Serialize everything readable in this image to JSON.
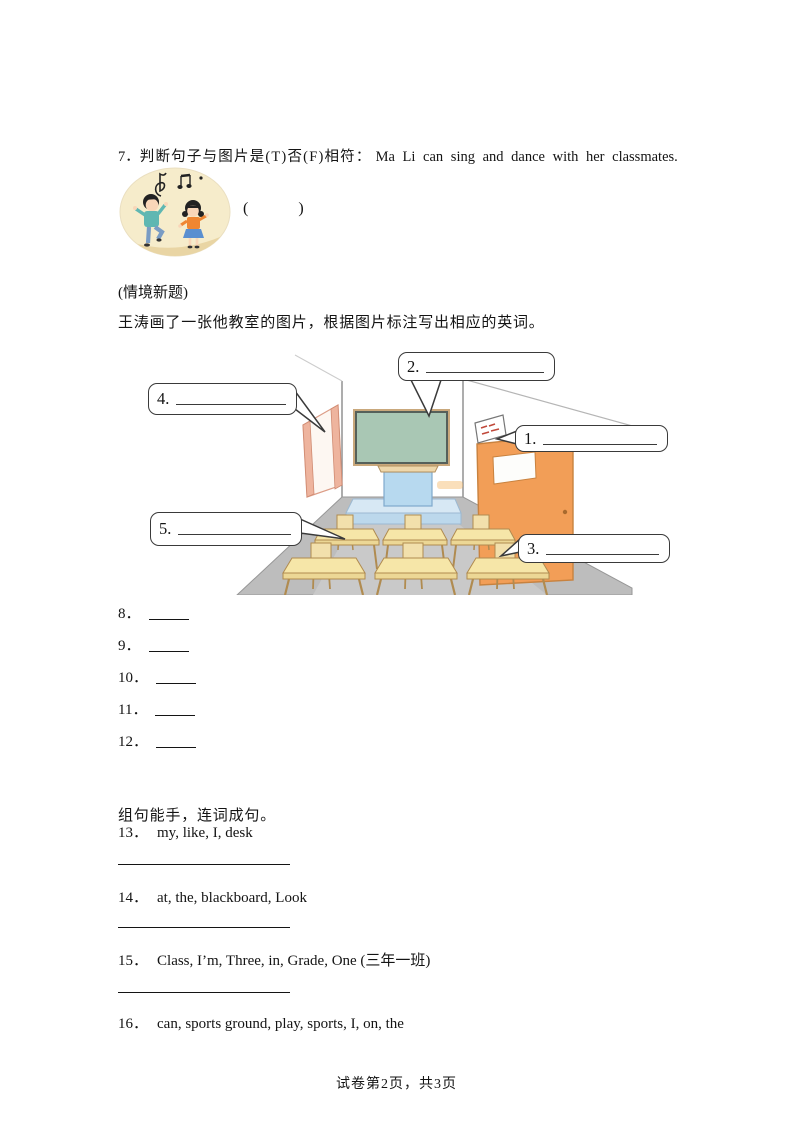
{
  "question7": {
    "number": "7．",
    "prompt": "判断句子与图片是(T)否(F)相符：",
    "sentence": "Ma Li can sing and dance with her classmates.",
    "answer_parens": "(        )"
  },
  "context_note": "(情境新题)",
  "instruction": "王涛画了一张他教室的图片，根据图片标注写出相应的英词。",
  "classroom": {
    "labels": [
      "1.",
      "2.",
      "3.",
      "4.",
      "5."
    ],
    "colors": {
      "blackboard_green": "#a9c7b4",
      "door_orange": "#f29e57",
      "podium_blue": "#b7d9ef",
      "platform_blue": "#d7e8f4",
      "desk_yellow": "#f6e6a8",
      "floor_gray": "#bdbdbd",
      "window_frame_salmon": "#eeb49e",
      "kids_background_cream": "#f6eccb"
    }
  },
  "fill_numbers": [
    "8．",
    "9．",
    "10．",
    "11．",
    "12．"
  ],
  "word_order": {
    "title": "组句能手，连词成句。",
    "items": [
      {
        "number": "13．",
        "words": "my, like, I, desk"
      },
      {
        "number": "14．",
        "words": "at, the, blackboard, Look"
      },
      {
        "number": "15．",
        "words": "Class, I’m, Three, in, Grade, One (三年一班)"
      },
      {
        "number": "16．",
        "words": "can, sports ground, play, sports, I, on, the"
      }
    ]
  },
  "footer": "试卷第2页，共3页"
}
